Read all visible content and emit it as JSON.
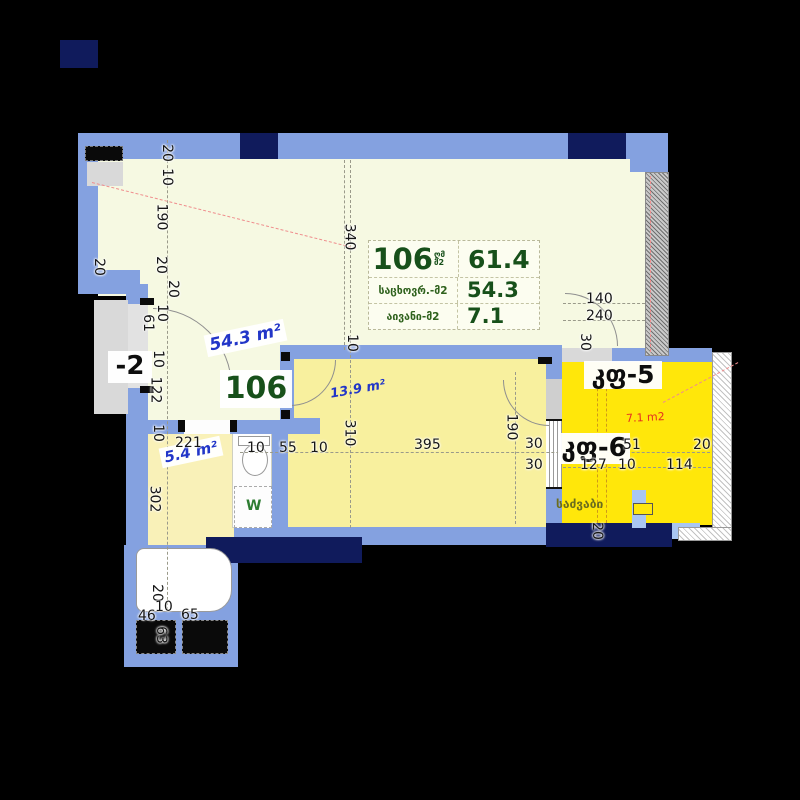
{
  "table": {
    "number": "106",
    "unit_top": "ღმ",
    "unit_bottom": "მ2",
    "rows": [
      {
        "label": "",
        "value": "61.4"
      },
      {
        "label": "საცხოვრ.-მ2",
        "value": "54.3"
      },
      {
        "label": "აივანი-მ2",
        "value": "7.1"
      }
    ]
  },
  "rooms": {
    "unit_tag": "106",
    "living_area": "54.3 m²",
    "bath_area": "5.4 m²",
    "bedroom_area": "13.9 m²",
    "balcony_area": "7.1 m2",
    "balcony5": "კფ-5",
    "balcony6": "კფ-6",
    "lobby": "-2",
    "storage": "საძვაბი",
    "washer": "W"
  },
  "colors": {
    "wall": "#84a1e0",
    "column": "#101b5c",
    "living": "#f6f9e2",
    "bedroom": "#f8f09e",
    "bath": "#f9f1b8",
    "balcony": "#ffe70a",
    "area_text": "#2236c8",
    "table_text": "#17501a",
    "balcony_area_text": "#e53020"
  },
  "dims": [
    "20",
    "10",
    "190",
    "20",
    "20",
    "20",
    "10",
    "61",
    "10",
    "122",
    "10",
    "302",
    "20",
    "10",
    "46",
    "65",
    "63",
    "340",
    "10",
    "310",
    "190",
    "30",
    "20",
    "221",
    "10",
    "55",
    "10",
    "395",
    "140",
    "240",
    "30",
    "30",
    "51",
    "20",
    "127",
    "10",
    "114"
  ]
}
